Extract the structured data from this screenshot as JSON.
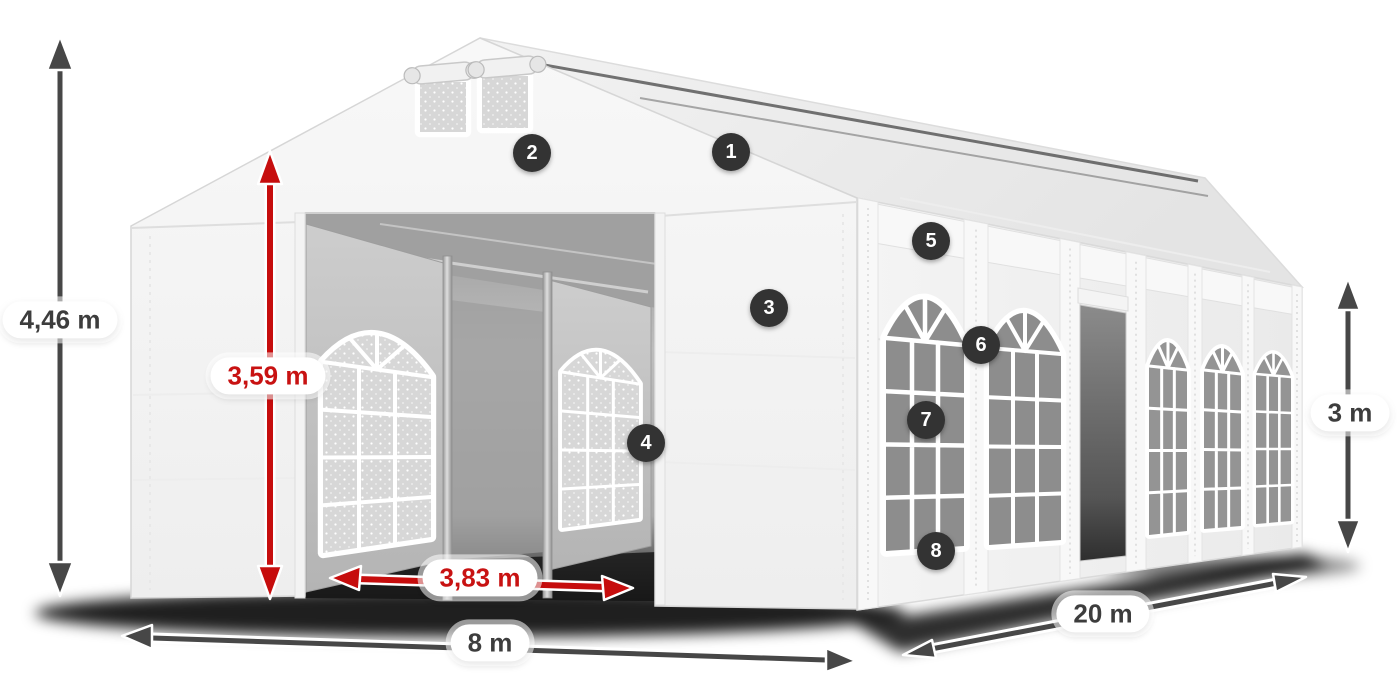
{
  "dimensions": {
    "total_height": {
      "label": "4,46 m"
    },
    "entrance_height": {
      "label": "3,59 m"
    },
    "entrance_width": {
      "label": "3,83 m"
    },
    "front_width": {
      "label": "8 m"
    },
    "length": {
      "label": "20 m"
    },
    "side_height": {
      "label": "3 m"
    }
  },
  "badges": [
    {
      "number": "1"
    },
    {
      "number": "2"
    },
    {
      "number": "3"
    },
    {
      "number": "4"
    },
    {
      "number": "5"
    },
    {
      "number": "6"
    },
    {
      "number": "7"
    },
    {
      "number": "8"
    }
  ],
  "colors": {
    "dimension_dark": "#474747",
    "dimension_red": "#c60d0d",
    "badge_background": "#333333",
    "badge_text": "#ffffff",
    "label_background": "#ffffff",
    "label_text_dark": "#3d3d3d",
    "label_text_red": "#c81212"
  }
}
